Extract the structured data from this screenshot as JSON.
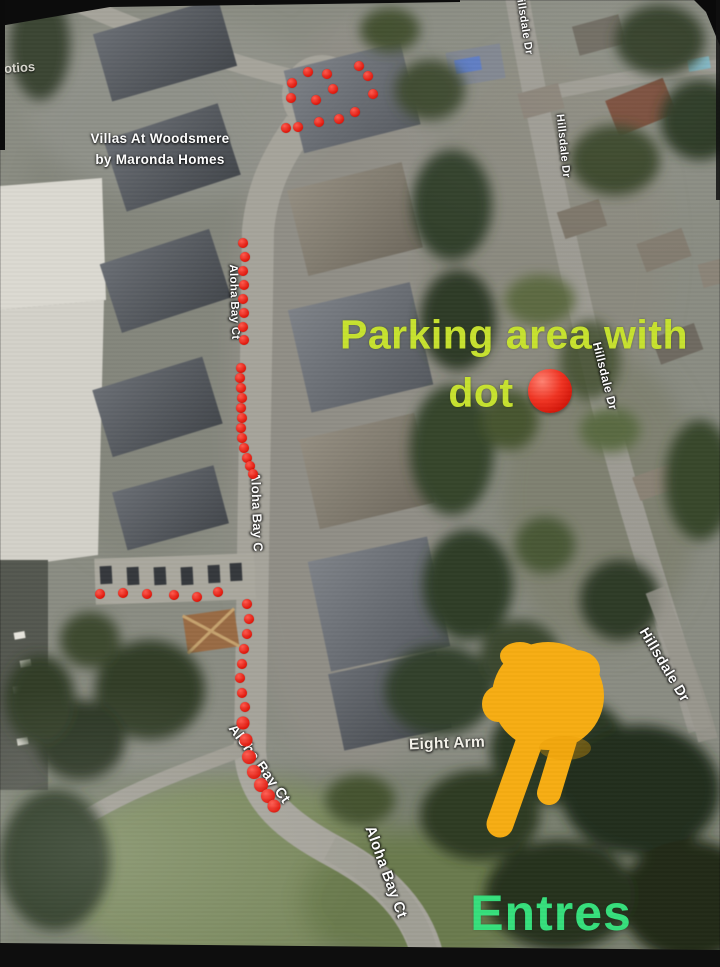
{
  "colors": {
    "parking_text": "#c7e22f",
    "entrance_text": "#36df7c",
    "route_dot_red": "#e01408",
    "hand_yellow": "#f7ad12",
    "street_label_white": "#ffffff"
  },
  "map": {
    "partial_left_label": "otios",
    "development_label": {
      "line1": "Villas At Woodsmere",
      "line2": "by Maronda Homes"
    },
    "poi_label": "Eight Arm",
    "street_labels": [
      {
        "text": "Hillsdale Dr"
      },
      {
        "text": "Hillsdale Dr"
      },
      {
        "text": "Hillsdale Dr"
      },
      {
        "text": "Hillsdale Dr"
      },
      {
        "text": "Aloha Bay Ct"
      },
      {
        "text": "Aloha Bay C"
      },
      {
        "text": "Aloha Bay Ct"
      },
      {
        "text": "Aloha Bay Ct"
      }
    ],
    "red_dots": {
      "culdesac_circle": [
        [
          308,
          72
        ],
        [
          327,
          74
        ],
        [
          359,
          66
        ],
        [
          368,
          76
        ],
        [
          292,
          83
        ],
        [
          333,
          89
        ],
        [
          373,
          94
        ],
        [
          291,
          98
        ],
        [
          316,
          100
        ],
        [
          355,
          112
        ],
        [
          339,
          119
        ],
        [
          319,
          122
        ],
        [
          298,
          127
        ],
        [
          286,
          128
        ]
      ],
      "path_upper": [
        [
          243,
          243
        ],
        [
          245,
          257
        ],
        [
          243,
          271
        ],
        [
          244,
          285
        ],
        [
          243,
          299
        ],
        [
          244,
          313
        ],
        [
          243,
          327
        ],
        [
          244,
          340
        ]
      ],
      "path_mid": [
        [
          241,
          368
        ],
        [
          240,
          378
        ],
        [
          241,
          388
        ],
        [
          242,
          398
        ],
        [
          241,
          408
        ],
        [
          242,
          418
        ],
        [
          241,
          428
        ],
        [
          242,
          438
        ],
        [
          244,
          448
        ],
        [
          247,
          458
        ],
        [
          250,
          466
        ],
        [
          253,
          474
        ]
      ],
      "path_lower": [
        [
          247,
          604
        ],
        [
          249,
          619
        ],
        [
          247,
          634
        ],
        [
          244,
          649
        ],
        [
          242,
          664
        ],
        [
          240,
          678
        ],
        [
          242,
          693
        ],
        [
          245,
          707
        ]
      ],
      "path_curve": [
        [
          243,
          723,
          13
        ],
        [
          246,
          740,
          13
        ],
        [
          249,
          757,
          14
        ],
        [
          254,
          772,
          14
        ],
        [
          261,
          785,
          14
        ],
        [
          268,
          796,
          14
        ],
        [
          274,
          806,
          13
        ]
      ],
      "branch_parking": [
        [
          100,
          594
        ],
        [
          123,
          593
        ],
        [
          147,
          594
        ],
        [
          174,
          595
        ],
        [
          197,
          597
        ],
        [
          218,
          592
        ]
      ]
    }
  },
  "annotations": {
    "parking_line1": "Parking area with",
    "parking_line2": "dot",
    "parking_marker_icon": "red-circle",
    "entrance_text": "Entres",
    "hand_icon": "backhand-index-pointing-down-left"
  }
}
